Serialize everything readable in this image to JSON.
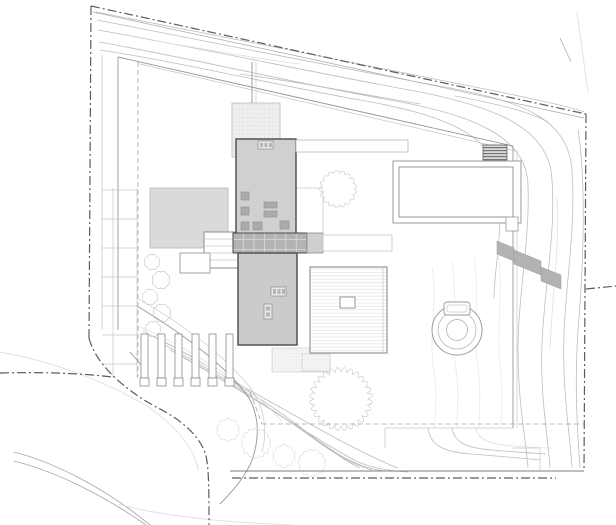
{
  "drawing": {
    "kind": "architectural-site-plan",
    "visible_text": [],
    "features": [
      {
        "name": "property-boundary",
        "style": "dash-dot"
      },
      {
        "name": "setback-line",
        "style": "dashed"
      },
      {
        "name": "topographic-contours",
        "style": "thin-gray-curves"
      },
      {
        "name": "driveway-curves",
        "style": "thin-gray-arcs"
      },
      {
        "name": "north-house-roof",
        "fill": "#d0d0d0"
      },
      {
        "name": "south-house-roof",
        "fill": "#cbcbcb"
      },
      {
        "name": "connecting-deck-bridge",
        "fill": "#b3b3b3",
        "pattern": "grid"
      },
      {
        "name": "roof-terrace",
        "pattern": "fine-grid"
      },
      {
        "name": "garage-roof",
        "fill": "#dadada"
      },
      {
        "name": "northeast-pavilion-roof",
        "fill": "#ffffff"
      },
      {
        "name": "southeast-pavilion-roof",
        "fill": "#ffffff",
        "pattern": "horizontal-hatch"
      },
      {
        "name": "vent-hatch",
        "pattern": "dark-horizontal-hatch"
      },
      {
        "name": "spa-hot-tub",
        "style": "concentric-circles"
      },
      {
        "name": "retaining-wall-steps",
        "fill": "#b2b2b2"
      },
      {
        "name": "stair-piers",
        "style": "outlined-posts"
      },
      {
        "name": "terraced-steps",
        "style": "thin-gray-rungs"
      },
      {
        "name": "trees-and-shrubs",
        "style": "scalloped-outlines"
      }
    ]
  },
  "colors": {
    "bg": "#ffffff",
    "boundary": "#5c5c5c",
    "boundarySolid": "#a8a8a8",
    "roadEdge": "#7d7d7d",
    "road": "#a8a8a8",
    "roadFaint": "#dfdfdf",
    "setback": "#a5a5a5",
    "contour": "#bdbdbd",
    "contourFaint": "#e0e0e0",
    "wavy": "#e9e9e9",
    "wall": "#969696",
    "wallLight": "#c6c6c6",
    "veg": "#cccccc",
    "vegFaint": "#dedede",
    "outlineDark": "#4a4a4a",
    "outline": "#8c8c8c",
    "outlineLight": "#b8b8b8",
    "northFill": "#d0d0d0",
    "southFill": "#cbcbcb",
    "garageFill": "#dadada",
    "deckFill": "#b3b3b3",
    "deckLine": "#d6d6d6",
    "deckExtFill": "#cfcfcf",
    "objFill": "#ababab",
    "objLine": "#8f8f8f",
    "chimFill": "#e8e8e8",
    "chimCell": "#b5b5b5",
    "retain": "#b2b2b2",
    "gridBg": "#efefef",
    "gridLine": "#dedede",
    "dotsBg": "#f5f5f5",
    "dotsLine": "#e6e6e6",
    "hatchLine": "#e3e3e3",
    "ventBg": "#d8d8d8",
    "ventLine": "#6e6e6e",
    "spaLine": "#9a9a9a"
  }
}
